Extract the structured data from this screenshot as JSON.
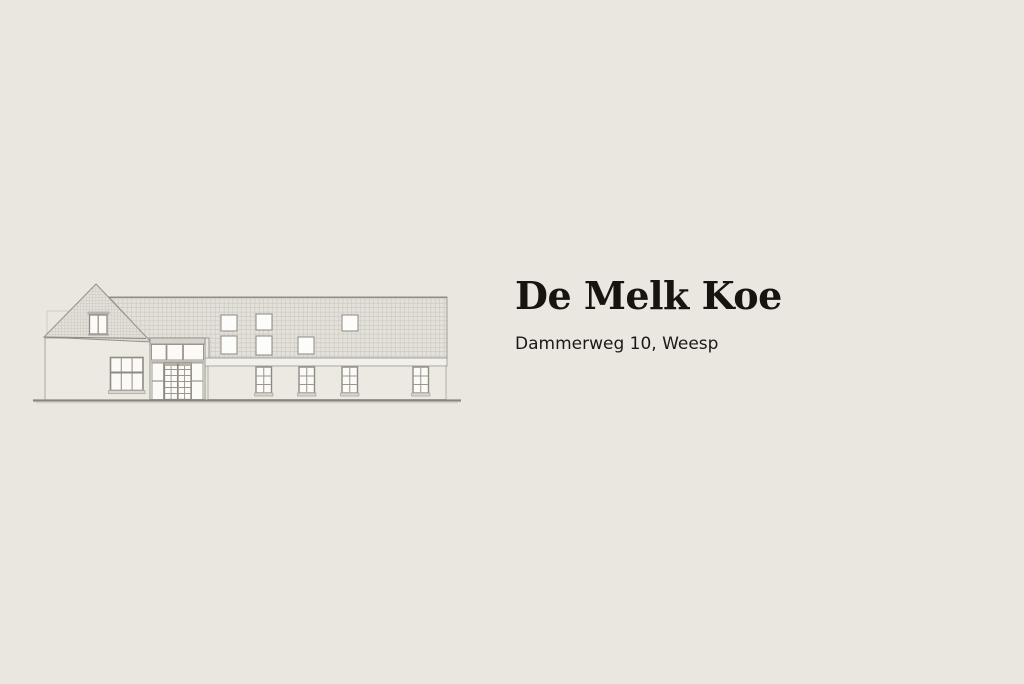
{
  "header": {
    "title": "De Melk Koe",
    "subtitle": "Dammerweg 10, Weesp"
  },
  "illustration": {
    "icon": "farmhouse-elevation-drawing-icon",
    "parts": [
      "gable-roof",
      "gable-window",
      "left-wall",
      "left-window",
      "entrance-glazing",
      "entrance-doors",
      "main-roof",
      "skylights",
      "fascia-band",
      "main-wall",
      "facade-windows",
      "ground-line"
    ]
  },
  "colors": {
    "background": "#eae7e1",
    "text": "#17130e",
    "wall_fill": "#ece9e3",
    "roof_fill": "#e4e1da",
    "roof_grid_line": "#c9c6bf",
    "outline": "#9a958e",
    "window_pane": "#fbfaf7",
    "ground_line": "#8a867f"
  }
}
